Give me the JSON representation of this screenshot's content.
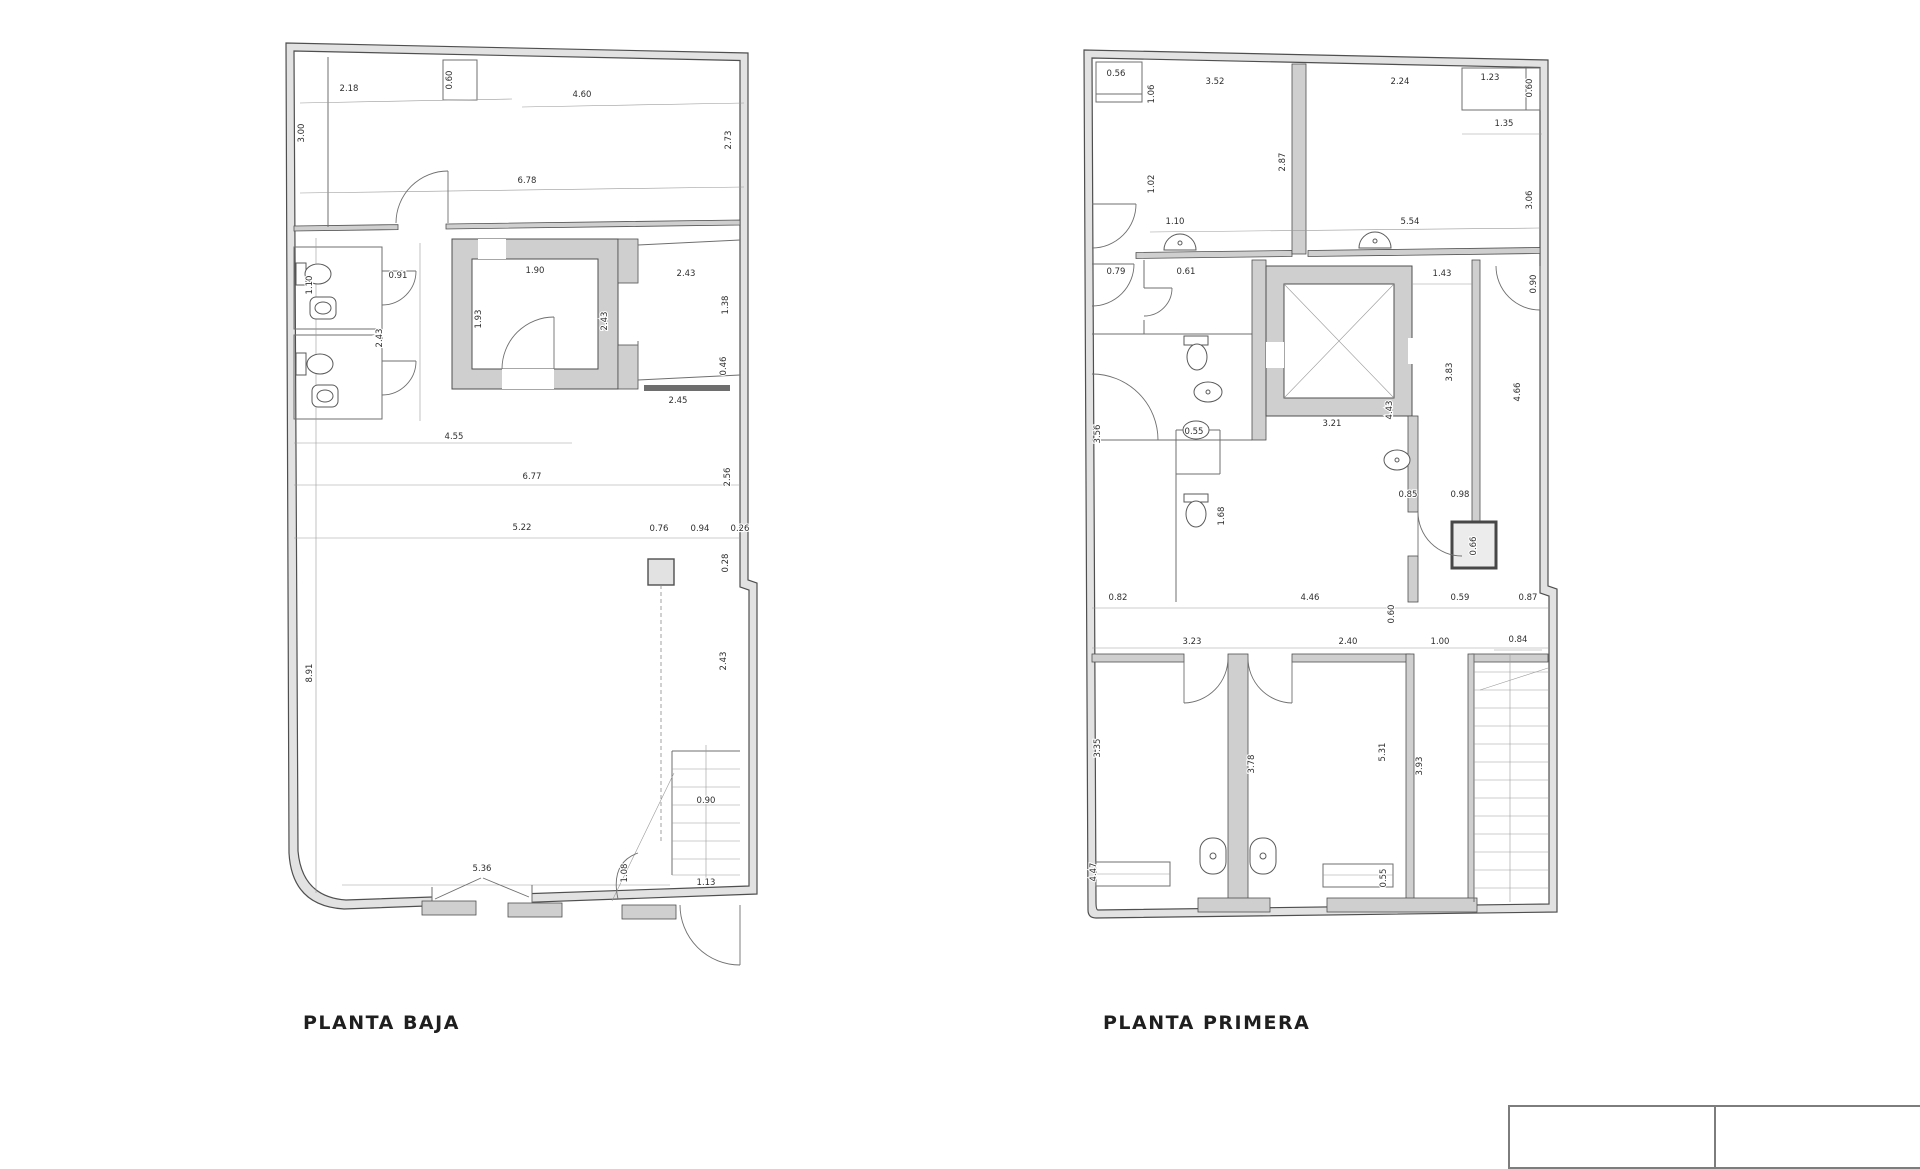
{
  "page": {
    "background_color": "#ffffff",
    "line_color": "#4f4f4f",
    "wall_fill": "#e2e2e2"
  },
  "plans": [
    {
      "id": "planta-baja",
      "title": "PLANTA BAJA",
      "dims": [
        {
          "x": 67,
          "y": 58,
          "r": 0,
          "v": "2.18"
        },
        {
          "x": 170,
          "y": 47,
          "r": 90,
          "v": "0.60"
        },
        {
          "x": 300,
          "y": 64,
          "r": 0,
          "v": "4.60"
        },
        {
          "x": 22,
          "y": 100,
          "r": 90,
          "v": "3.00"
        },
        {
          "x": 449,
          "y": 107,
          "r": 90,
          "v": "2.73"
        },
        {
          "x": 245,
          "y": 150,
          "r": 0,
          "v": "6.78"
        },
        {
          "x": 30,
          "y": 252,
          "r": 90,
          "v": "1.10"
        },
        {
          "x": 116,
          "y": 245,
          "r": 0,
          "v": "0.91"
        },
        {
          "x": 100,
          "y": 305,
          "r": 90,
          "v": "2.43"
        },
        {
          "x": 253,
          "y": 240,
          "r": 0,
          "v": "1.90"
        },
        {
          "x": 199,
          "y": 286,
          "r": 90,
          "v": "1.93"
        },
        {
          "x": 325,
          "y": 288,
          "r": 90,
          "v": "2.43"
        },
        {
          "x": 404,
          "y": 243,
          "r": 0,
          "v": "2.43"
        },
        {
          "x": 446,
          "y": 272,
          "r": 90,
          "v": "1.38"
        },
        {
          "x": 444,
          "y": 333,
          "r": 90,
          "v": "0.46"
        },
        {
          "x": 396,
          "y": 370,
          "r": 0,
          "v": "2.45"
        },
        {
          "x": 172,
          "y": 406,
          "r": 0,
          "v": "4.55"
        },
        {
          "x": 250,
          "y": 446,
          "r": 0,
          "v": "6.77"
        },
        {
          "x": 448,
          "y": 444,
          "r": 90,
          "v": "2.56"
        },
        {
          "x": 240,
          "y": 497,
          "r": 0,
          "v": "5.22"
        },
        {
          "x": 377,
          "y": 498,
          "r": 0,
          "v": "0.76"
        },
        {
          "x": 418,
          "y": 498,
          "r": 0,
          "v": "0.94"
        },
        {
          "x": 458,
          "y": 498,
          "r": 0,
          "v": "0.26"
        },
        {
          "x": 446,
          "y": 530,
          "r": 90,
          "v": "0.28"
        },
        {
          "x": 30,
          "y": 640,
          "r": 90,
          "v": "8.91"
        },
        {
          "x": 444,
          "y": 628,
          "r": 90,
          "v": "2.43"
        },
        {
          "x": 424,
          "y": 770,
          "r": 0,
          "v": "0.90"
        },
        {
          "x": 200,
          "y": 838,
          "r": 0,
          "v": "5.36"
        },
        {
          "x": 345,
          "y": 840,
          "r": 90,
          "v": "1.08"
        },
        {
          "x": 424,
          "y": 852,
          "r": 0,
          "v": "1.13"
        }
      ]
    },
    {
      "id": "planta-primera",
      "title": "PLANTA PRIMERA",
      "dims": [
        {
          "x": 36,
          "y": 34,
          "r": 0,
          "v": "0.56"
        },
        {
          "x": 74,
          "y": 52,
          "r": 90,
          "v": "1.06"
        },
        {
          "x": 135,
          "y": 42,
          "r": 0,
          "v": "3.52"
        },
        {
          "x": 320,
          "y": 42,
          "r": 0,
          "v": "2.24"
        },
        {
          "x": 410,
          "y": 38,
          "r": 0,
          "v": "1.23"
        },
        {
          "x": 452,
          "y": 46,
          "r": 90,
          "v": "0.60"
        },
        {
          "x": 424,
          "y": 84,
          "r": 0,
          "v": "1.35"
        },
        {
          "x": 205,
          "y": 120,
          "r": 90,
          "v": "2.87"
        },
        {
          "x": 74,
          "y": 142,
          "r": 90,
          "v": "1.02"
        },
        {
          "x": 452,
          "y": 158,
          "r": 90,
          "v": "3.06"
        },
        {
          "x": 95,
          "y": 182,
          "r": 0,
          "v": "1.10"
        },
        {
          "x": 330,
          "y": 182,
          "r": 0,
          "v": "5.54"
        },
        {
          "x": 36,
          "y": 232,
          "r": 0,
          "v": "0.79"
        },
        {
          "x": 106,
          "y": 232,
          "r": 0,
          "v": "0.61"
        },
        {
          "x": 362,
          "y": 234,
          "r": 0,
          "v": "1.43"
        },
        {
          "x": 456,
          "y": 242,
          "r": 90,
          "v": "0.90"
        },
        {
          "x": 20,
          "y": 392,
          "r": 90,
          "v": "3.56"
        },
        {
          "x": 252,
          "y": 384,
          "r": 0,
          "v": "3.21"
        },
        {
          "x": 114,
          "y": 392,
          "r": 0,
          "v": "0.55"
        },
        {
          "x": 372,
          "y": 330,
          "r": 90,
          "v": "3.83"
        },
        {
          "x": 440,
          "y": 350,
          "r": 90,
          "v": "4.66"
        },
        {
          "x": 312,
          "y": 368,
          "r": 90,
          "v": "4.43"
        },
        {
          "x": 144,
          "y": 474,
          "r": 90,
          "v": "1.68"
        },
        {
          "x": 328,
          "y": 455,
          "r": 0,
          "v": "0.85"
        },
        {
          "x": 380,
          "y": 455,
          "r": 0,
          "v": "0.98"
        },
        {
          "x": 396,
          "y": 504,
          "r": 90,
          "v": "0.66"
        },
        {
          "x": 38,
          "y": 558,
          "r": 0,
          "v": "0.82"
        },
        {
          "x": 230,
          "y": 558,
          "r": 0,
          "v": "4.46"
        },
        {
          "x": 314,
          "y": 572,
          "r": 90,
          "v": "0.60"
        },
        {
          "x": 380,
          "y": 558,
          "r": 0,
          "v": "0.59"
        },
        {
          "x": 448,
          "y": 558,
          "r": 0,
          "v": "0.87"
        },
        {
          "x": 112,
          "y": 602,
          "r": 0,
          "v": "3.23"
        },
        {
          "x": 268,
          "y": 602,
          "r": 0,
          "v": "2.40"
        },
        {
          "x": 360,
          "y": 602,
          "r": 0,
          "v": "1.00"
        },
        {
          "x": 438,
          "y": 600,
          "r": 0,
          "v": "0.84"
        },
        {
          "x": 20,
          "y": 706,
          "r": 90,
          "v": "3.35"
        },
        {
          "x": 174,
          "y": 722,
          "r": 90,
          "v": "3.78"
        },
        {
          "x": 305,
          "y": 710,
          "r": 90,
          "v": "5.31"
        },
        {
          "x": 342,
          "y": 724,
          "r": 90,
          "v": "3.93"
        },
        {
          "x": 16,
          "y": 830,
          "r": 90,
          "v": "4.47"
        },
        {
          "x": 306,
          "y": 836,
          "r": 90,
          "v": "0.55"
        }
      ]
    }
  ],
  "title_block": {
    "left_cell": "",
    "right_cell": ""
  }
}
